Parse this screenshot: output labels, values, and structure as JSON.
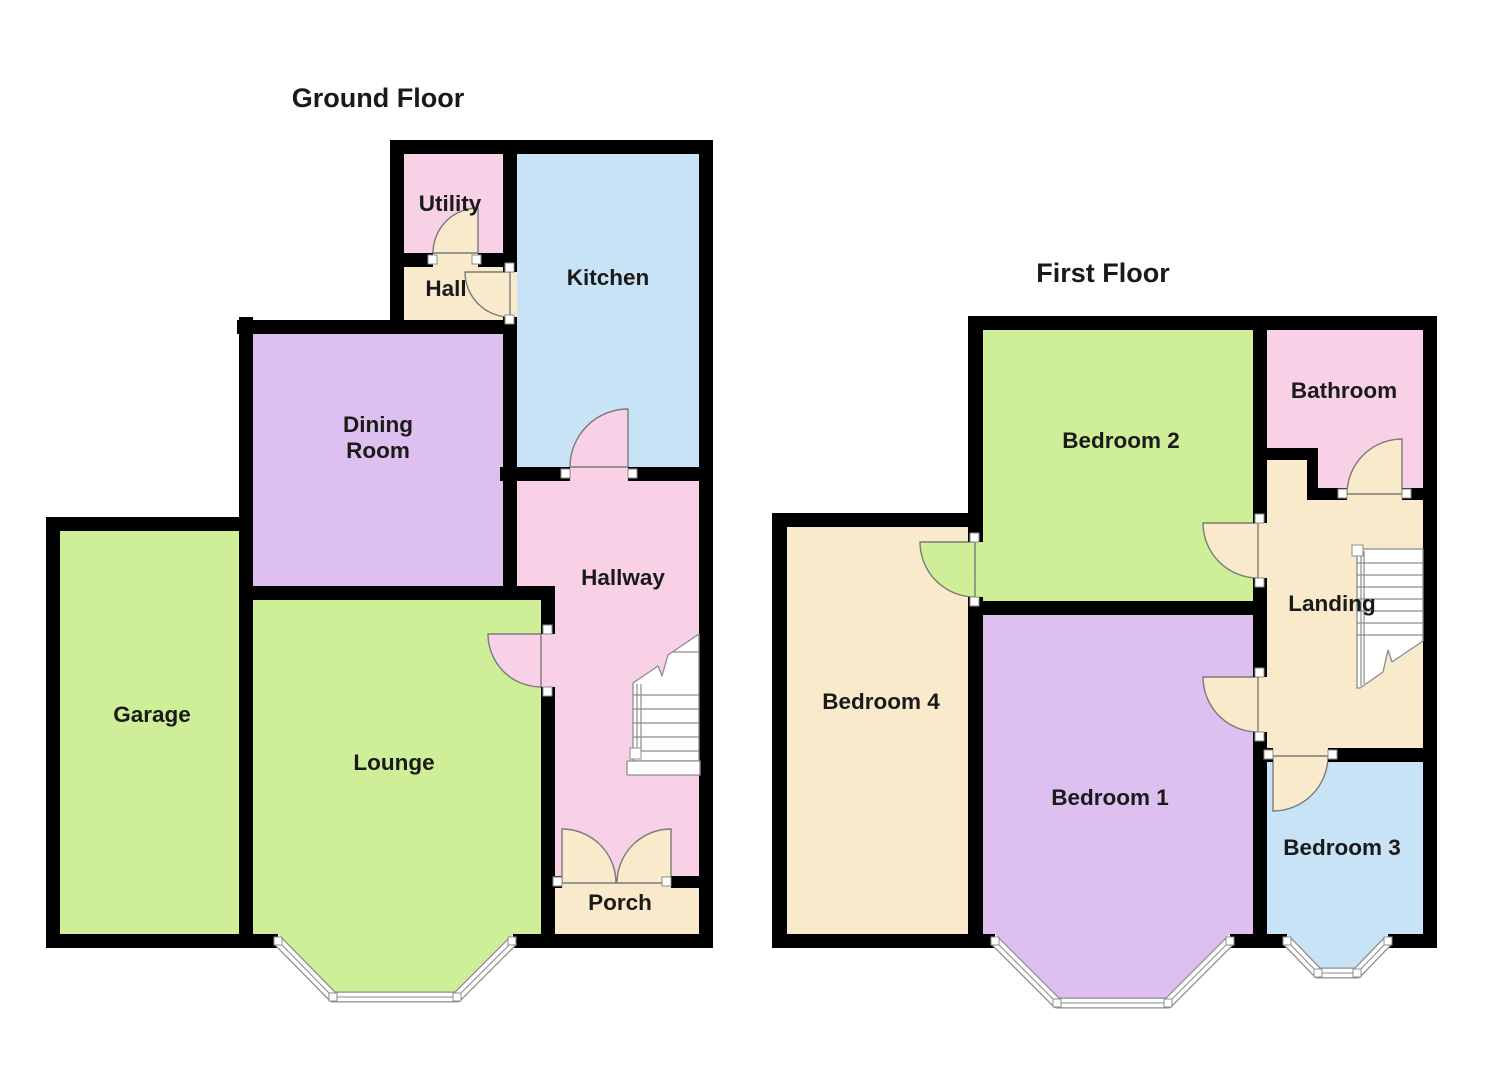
{
  "palette": {
    "wall": "#000000",
    "green": "#CEEF97",
    "purple": "#DDBFF0",
    "pink": "#F9D1E7",
    "blue": "#C9E3F6",
    "cream": "#FAEACC",
    "text": "#1A1A1A",
    "line": "#7A7A7A"
  },
  "floors": [
    {
      "title": "Ground Floor",
      "rooms": [
        {
          "id": "utility",
          "label": "Utility"
        },
        {
          "id": "hall",
          "label": "Hall"
        },
        {
          "id": "kitchen",
          "label": "Kitchen"
        },
        {
          "id": "dining-room",
          "label_lines": [
            "Dining",
            "Room"
          ]
        },
        {
          "id": "hallway",
          "label": "Hallway"
        },
        {
          "id": "garage",
          "label": "Garage"
        },
        {
          "id": "lounge",
          "label": "Lounge"
        },
        {
          "id": "porch",
          "label": "Porch"
        }
      ]
    },
    {
      "title": "First Floor",
      "rooms": [
        {
          "id": "bedroom-2",
          "label": "Bedroom 2"
        },
        {
          "id": "bathroom",
          "label": "Bathroom"
        },
        {
          "id": "landing",
          "label": "Landing"
        },
        {
          "id": "bedroom-4",
          "label": "Bedroom 4"
        },
        {
          "id": "bedroom-1",
          "label": "Bedroom 1"
        },
        {
          "id": "bedroom-3",
          "label": "Bedroom 3"
        }
      ]
    }
  ]
}
